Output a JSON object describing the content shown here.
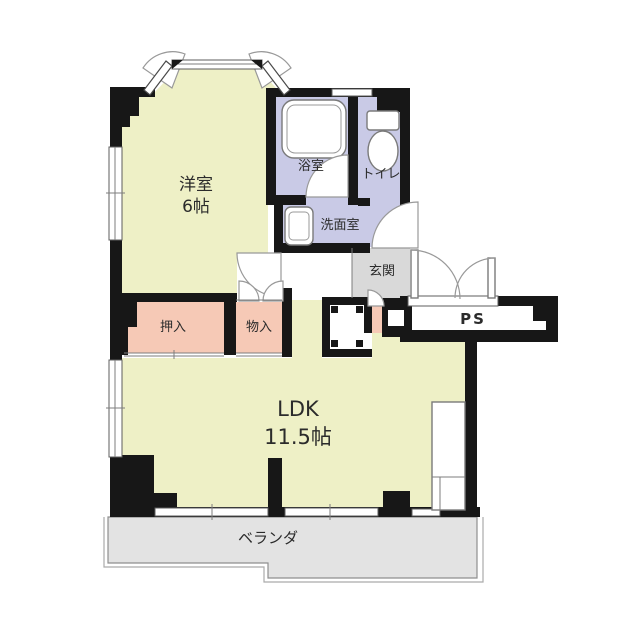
{
  "document_type": "apartment-floorplan",
  "rooms": {
    "western": {
      "name": "洋室",
      "size": "6帖"
    },
    "ldk": {
      "name": "LDK",
      "size": "11.5帖"
    },
    "bath": {
      "name": "浴室"
    },
    "toilet": {
      "name": "トイレ"
    },
    "washroom": {
      "name": "洗面室"
    },
    "entrance": {
      "name": "玄関"
    },
    "pipe_space": {
      "name": "PS"
    },
    "closet": {
      "name": "押入"
    },
    "storage": {
      "name": "物入"
    },
    "veranda": {
      "name": "ベランダ"
    }
  },
  "colors": {
    "wall": "#171717",
    "room_yellow": "#eef0c6",
    "wet_area_lavender": "#c9cae6",
    "closet_pink": "#f6c9b6",
    "entrance_gray": "#d9d9d9",
    "veranda_gray": "#e3e3e3",
    "background": "#ffffff"
  }
}
